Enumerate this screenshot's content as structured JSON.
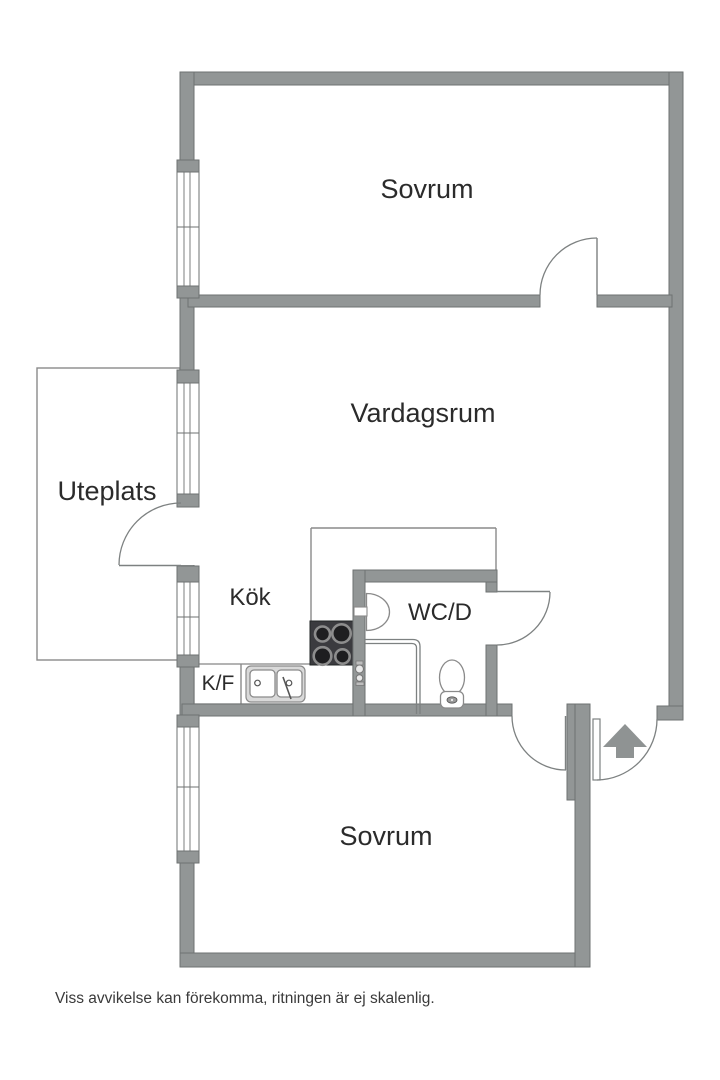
{
  "floorplan": {
    "rooms": [
      {
        "id": "sovrum-top",
        "label": "Sovrum"
      },
      {
        "id": "vardagsrum",
        "label": "Vardagsrum"
      },
      {
        "id": "uteplats",
        "label": "Uteplats"
      },
      {
        "id": "kok",
        "label": "Kök"
      },
      {
        "id": "wcd",
        "label": "WC/D"
      },
      {
        "id": "kf",
        "label": "K/F"
      },
      {
        "id": "sovrum-bottom",
        "label": "Sovrum"
      }
    ],
    "disclaimer": "Viss avvikelse kan förekomma, ritningen är ej skalenlig.",
    "icons": {
      "entrance": "arrow-up",
      "stove": "four-burner-cooktop",
      "sink": "double-basin-sink",
      "toilet": "toilet",
      "washbasin": "half-round-basin",
      "shower": "shower-mixer",
      "windows": "triple-line-window",
      "doors": "quarter-circle-swing"
    },
    "colors": {
      "wall": "#929696",
      "wall_outline": "#6e7272",
      "line": "#8a8a8a",
      "stove": "#3b3b3f",
      "text": "#2b2b2b",
      "arrow": "#8f9393",
      "background": "#ffffff"
    }
  }
}
